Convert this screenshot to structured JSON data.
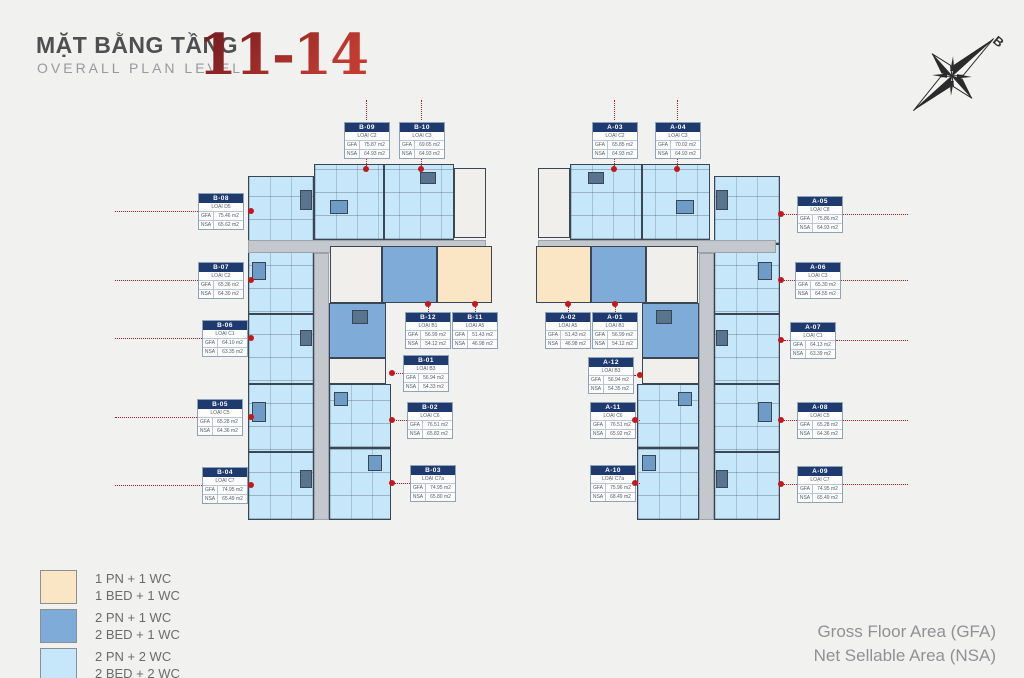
{
  "header": {
    "title_vi": "MẶT BẰNG TẦNG",
    "title_en": "OVERALL PLAN LEVEL",
    "levels": "11-14"
  },
  "compass": {
    "north_label": "B"
  },
  "labels": {
    "gfa": "GFA",
    "nsa": "NSA"
  },
  "footer": {
    "gfa_full": "Gross Floor Area (GFA)",
    "nsa_full": "Net Sellable Area (NSA)"
  },
  "legend": {
    "items": [
      {
        "color": "#FAE5C4",
        "line1": "1 PN + 1 WC",
        "line2": "1 BED + 1 WC"
      },
      {
        "color": "#7EABD7",
        "line1": "2 PN + 1 WC",
        "line2": "2 BED + 1 WC"
      },
      {
        "color": "#C6E7F9",
        "line1": "2 PN + 2 WC",
        "line2": "2 BED + 2 WC"
      }
    ]
  },
  "colors": {
    "background": "#F1F1F0",
    "accent_red": "#C3191D",
    "callout_navy": "#1E3A6E",
    "wall": "#3A4654",
    "corridor": "#C4C8CD",
    "title_red": "#A02C28"
  },
  "units": {
    "b": [
      {
        "id": "B-01",
        "type": "LOẠI B3",
        "gfa": "56.94 m2",
        "nsa": "54.33 m2"
      },
      {
        "id": "B-02",
        "type": "LOẠI C6",
        "gfa": "76.51 m2",
        "nsa": "65.82 m2"
      },
      {
        "id": "B-03",
        "type": "LOẠI C7a",
        "gfa": "74.95 m2",
        "nsa": "65.80 m2"
      },
      {
        "id": "B-04",
        "type": "LOẠI C7",
        "gfa": "74.95 m2",
        "nsa": "65.49 m2"
      },
      {
        "id": "B-05",
        "type": "LOẠI C5",
        "gfa": "65.28 m2",
        "nsa": "64.36 m2"
      },
      {
        "id": "B-06",
        "type": "LOẠI C1",
        "gfa": "64.10 m2",
        "nsa": "63.35 m2"
      },
      {
        "id": "B-07",
        "type": "LOẠI C2",
        "gfa": "65.36 m2",
        "nsa": "64.30 m2"
      },
      {
        "id": "B-08",
        "type": "LOẠI D5",
        "gfa": "75.46 m2",
        "nsa": "65.62 m2"
      },
      {
        "id": "B-09",
        "type": "LOẠI C2",
        "gfa": "75.87 m2",
        "nsa": "64.93 m2"
      },
      {
        "id": "B-10",
        "type": "LOẠI C3",
        "gfa": "69.65 m2",
        "nsa": "64.93 m2"
      },
      {
        "id": "B-11",
        "type": "LOẠI A5",
        "gfa": "51.43 m2",
        "nsa": "46.98 m2"
      },
      {
        "id": "B-12",
        "type": "LOẠI B1",
        "gfa": "56.99 m2",
        "nsa": "54.12 m2"
      }
    ],
    "a": [
      {
        "id": "A-01",
        "type": "LOẠI B1",
        "gfa": "56.99 m2",
        "nsa": "54.12 m2"
      },
      {
        "id": "A-02",
        "type": "LOẠI A5",
        "gfa": "51.43 m2",
        "nsa": "46.98 m2"
      },
      {
        "id": "A-03",
        "type": "LOẠI C2",
        "gfa": "65.85 m2",
        "nsa": "64.93 m2"
      },
      {
        "id": "A-04",
        "type": "LOẠI C3",
        "gfa": "70.02 m2",
        "nsa": "64.93 m2"
      },
      {
        "id": "A-05",
        "type": "LOẠI C8",
        "gfa": "75.86 m2",
        "nsa": "64.93 m2"
      },
      {
        "id": "A-06",
        "type": "LOẠI C3",
        "gfa": "65.30 m2",
        "nsa": "64.55 m2"
      },
      {
        "id": "A-07",
        "type": "LOẠI C1",
        "gfa": "64.13 m2",
        "nsa": "63.39 m2"
      },
      {
        "id": "A-08",
        "type": "LOẠI C5",
        "gfa": "65.28 m2",
        "nsa": "64.36 m2"
      },
      {
        "id": "A-09",
        "type": "LOẠI C7",
        "gfa": "74.95 m2",
        "nsa": "65.49 m2"
      },
      {
        "id": "A-10",
        "type": "LOẠI C7a",
        "gfa": "75.96 m2",
        "nsa": "68.49 m2"
      },
      {
        "id": "A-11",
        "type": "LOẠI C6",
        "gfa": "76.51 m2",
        "nsa": "65.92 m2"
      },
      {
        "id": "A-12",
        "type": "LOẠI B3",
        "gfa": "56.94 m2",
        "nsa": "54.35 m2"
      }
    ]
  }
}
